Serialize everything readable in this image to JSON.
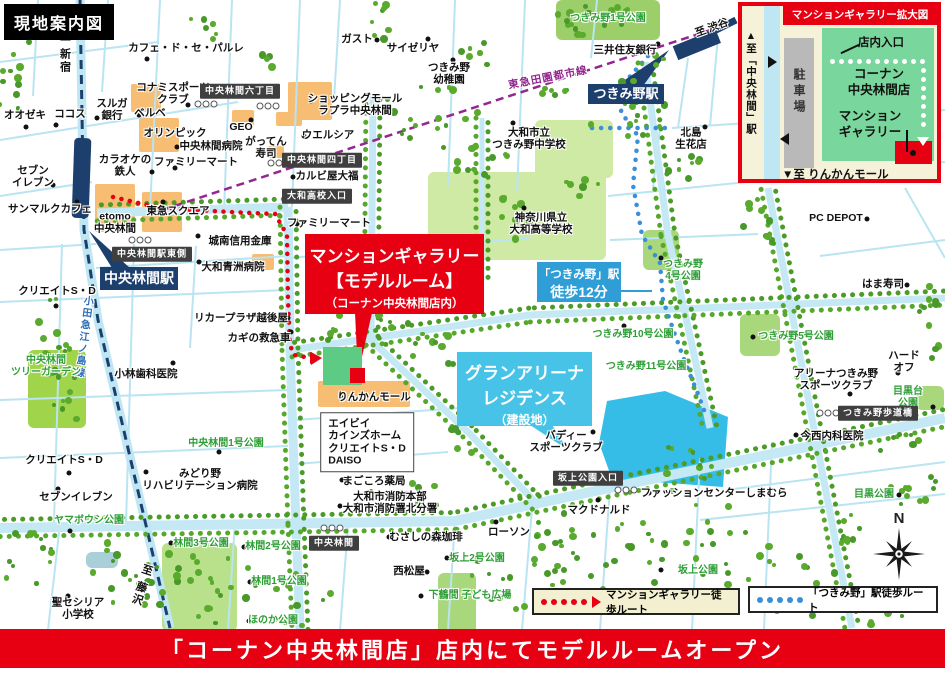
{
  "title": "現地案内図",
  "banner": "「コーナン中央林間店」店内にてモデルルームオープン",
  "compass": "N",
  "colors": {
    "accent_red": "#e60012",
    "navy": "#1c3f6e",
    "rail_purple": "#93278f",
    "route_blue": "#3a8fd8",
    "walk_box_blue": "#2f9ed6",
    "site_cyan": "#35bde8",
    "callout_cyan": "#47c3e8"
  },
  "legend": {
    "red_label": "マンションギャラリー徒歩ルート",
    "blue_label": "「つきみ野」駅徒歩ルート"
  },
  "stations": {
    "chuo_rinkan": "中央林間駅",
    "tsukimino": "つきみ野駅"
  },
  "callouts": {
    "gallery": {
      "line1": "マンションギャラリー",
      "line2": "【モデルルーム】",
      "line3": "（コーナン中央林間店内）"
    },
    "walk": {
      "line1": "「つきみ野」駅",
      "line2": "徒歩12分"
    },
    "site": {
      "line1": "グランアリーナ",
      "line2": "レジデンス",
      "line3": "（建設地）"
    }
  },
  "inset": {
    "title": "マンションギャラリー拡大図",
    "to_station": "▲至「中央林間」駅",
    "parking": "駐車場",
    "entrance": "店内入口",
    "store": "コーナン\n中央林間店",
    "gallery": "マンション\nギャラリー",
    "to_mall": "▼至 りんかんモール"
  },
  "map_labels": [
    {
      "t": "オオゼキ",
      "x": 25,
      "y": 115,
      "d": [
        26,
        127
      ]
    },
    {
      "t": "ココス",
      "x": 70,
      "y": 114,
      "d": [
        56,
        125
      ]
    },
    {
      "t": "至 新宿",
      "x": 64,
      "y": 52,
      "c": "railv"
    },
    {
      "t": "カフェ・ド・セ・パルレ",
      "x": 186,
      "y": 48,
      "d": [
        147,
        59
      ]
    },
    {
      "t": "スルガ\n銀行",
      "x": 112,
      "y": 110,
      "d": [
        97,
        118
      ]
    },
    {
      "t": "コナミスポーツ\nクラブ",
      "x": 173,
      "y": 94,
      "d": [
        188,
        105
      ]
    },
    {
      "t": "ベルベ",
      "x": 150,
      "y": 113,
      "d": [
        139,
        115
      ]
    },
    {
      "t": "中央林間六丁目",
      "x": 240,
      "y": 91,
      "c": "badge"
    },
    {
      "t": "オリンピック",
      "x": 175,
      "y": 133,
      "d": [
        148,
        134
      ]
    },
    {
      "t": "中央林間病院",
      "x": 211,
      "y": 146,
      "d": [
        177,
        147
      ]
    },
    {
      "t": "GEO",
      "x": 241,
      "y": 127,
      "d": [
        251,
        120
      ]
    },
    {
      "t": "がってん\n寿司",
      "x": 266,
      "y": 148
    },
    {
      "t": "カラオケの\n鉄人",
      "x": 125,
      "y": 166,
      "d": [
        152,
        172
      ]
    },
    {
      "t": "ファミリーマート",
      "x": 196,
      "y": 162,
      "d": [
        175,
        168
      ]
    },
    {
      "t": "セブン\nイレブン",
      "x": 33,
      "y": 177,
      "d": [
        53,
        185
      ]
    },
    {
      "t": "サンマルクカフェ",
      "x": 50,
      "y": 209,
      "d": [
        77,
        202
      ]
    },
    {
      "t": "etomo\n中央林間",
      "x": 115,
      "y": 223
    },
    {
      "t": "東急スクエア",
      "x": 178,
      "y": 211,
      "d": [
        163,
        202
      ]
    },
    {
      "t": "ガスト",
      "x": 357,
      "y": 39,
      "d": [
        377,
        40
      ]
    },
    {
      "t": "サイゼリヤ",
      "x": 413,
      "y": 48,
      "d": [
        428,
        39
      ]
    },
    {
      "t": "つきみ野\n幼稚園",
      "x": 449,
      "y": 74,
      "d": [
        453,
        60
      ]
    },
    {
      "t": "ショッピングモール\nラプラ中央林間",
      "x": 355,
      "y": 105,
      "d": [
        311,
        101
      ]
    },
    {
      "t": "ウエルシア",
      "x": 328,
      "y": 135,
      "d": [
        304,
        136
      ]
    },
    {
      "t": "中央林間四丁目",
      "x": 322,
      "y": 160,
      "c": "badge"
    },
    {
      "t": "カルビ屋大福",
      "x": 327,
      "y": 176,
      "d": [
        293,
        177
      ]
    },
    {
      "t": "大和高校入口",
      "x": 317,
      "y": 196,
      "c": "badge"
    },
    {
      "t": "ファミリーマート",
      "x": 329,
      "y": 223,
      "d": [
        297,
        224
      ]
    },
    {
      "t": "三井住友銀行",
      "x": 625,
      "y": 50,
      "d": [
        658,
        44
      ]
    },
    {
      "t": "至 渋谷",
      "x": 712,
      "y": 28,
      "r": -20
    },
    {
      "t": "東急田園都市線",
      "x": 548,
      "y": 78,
      "c": "railp",
      "r": -11
    },
    {
      "t": "北島\n生花店",
      "x": 691,
      "y": 139,
      "d": [
        705,
        127
      ]
    },
    {
      "t": "つきみ野1号公園",
      "x": 608,
      "y": 19,
      "c": "park-t"
    },
    {
      "t": "大和市立\nつきみ野中学校",
      "x": 529,
      "y": 139,
      "d": [
        513,
        123
      ]
    },
    {
      "t": "神奈川県立\n大和高等学校",
      "x": 541,
      "y": 224,
      "d": [
        524,
        208
      ]
    },
    {
      "t": "城南信用金庫",
      "x": 240,
      "y": 241,
      "d": [
        198,
        236
      ]
    },
    {
      "t": "大和青洲病院",
      "x": 233,
      "y": 267,
      "d": [
        199,
        262
      ]
    },
    {
      "t": "中央林間駅東側",
      "x": 152,
      "y": 254,
      "c": "badge"
    },
    {
      "t": "クリエイトS・D",
      "x": 57,
      "y": 291,
      "d": [
        56,
        306
      ]
    },
    {
      "t": "リカープラザ越後屋",
      "x": 241,
      "y": 318,
      "d": [
        288,
        318
      ]
    },
    {
      "t": "カギの救急車",
      "x": 259,
      "y": 338,
      "d": [
        291,
        332
      ]
    },
    {
      "t": "小田急江ノ島線",
      "x": 82,
      "y": 337,
      "c": "railb",
      "r": 7
    },
    {
      "t": "中央林間\nツリーガーデン",
      "x": 46,
      "y": 367,
      "c": "park-t"
    },
    {
      "t": "小林歯科医院",
      "x": 146,
      "y": 374,
      "d": [
        173,
        363
      ]
    },
    {
      "t": "つきみ野\n4号公園",
      "x": 683,
      "y": 271,
      "c": "park-t",
      "d": [
        661,
        258
      ]
    },
    {
      "t": "つきみ野10号公園",
      "x": 633,
      "y": 335,
      "c": "park-t",
      "d": [
        624,
        326
      ]
    },
    {
      "t": "つきみ野11号公園",
      "x": 646,
      "y": 367,
      "c": "park-t"
    },
    {
      "t": "つきみ野5号公園",
      "x": 796,
      "y": 337,
      "c": "park-t",
      "d": [
        753,
        337
      ]
    },
    {
      "t": "PC DEPOT",
      "x": 836,
      "y": 218,
      "d": [
        867,
        219
      ]
    },
    {
      "t": "はま寿司",
      "x": 883,
      "y": 284,
      "d": [
        907,
        285
      ]
    },
    {
      "t": "ハードオフ",
      "x": 904,
      "y": 362,
      "d": [
        898,
        373
      ]
    },
    {
      "t": "アリーナつきみ野\nスポーツクラブ",
      "x": 836,
      "y": 380,
      "d": [
        850,
        394
      ]
    },
    {
      "t": "目黒台公園",
      "x": 908,
      "y": 398,
      "c": "park-t",
      "d": [
        933,
        407
      ]
    },
    {
      "t": "つきみ野歩道橋",
      "x": 878,
      "y": 413,
      "c": "badge"
    },
    {
      "t": "今西内科医院",
      "x": 832,
      "y": 436,
      "d": [
        796,
        435
      ]
    },
    {
      "t": "目黒公園",
      "x": 874,
      "y": 495,
      "c": "park-t",
      "d": [
        899,
        495
      ]
    },
    {
      "t": "バディー\nスポーツクラブ",
      "x": 566,
      "y": 442,
      "d": [
        593,
        432
      ]
    },
    {
      "t": "坂上公園入口",
      "x": 588,
      "y": 478,
      "c": "badge"
    },
    {
      "t": "ファッションセンターしまむら",
      "x": 714,
      "y": 493,
      "d": [
        649,
        493
      ]
    },
    {
      "t": "マクドナルド",
      "x": 599,
      "y": 510,
      "d": [
        598,
        500
      ]
    },
    {
      "t": "坂上公園",
      "x": 698,
      "y": 571,
      "c": "park-t",
      "d": [
        661,
        570
      ]
    },
    {
      "t": "中央林間1号公園",
      "x": 226,
      "y": 444,
      "c": "park-t",
      "d": [
        219,
        452
      ]
    },
    {
      "t": "クリエイトS・D",
      "x": 64,
      "y": 460,
      "d": [
        69,
        473
      ]
    },
    {
      "t": "みどり野\nリハビリテーション病院",
      "x": 200,
      "y": 480,
      "d": [
        146,
        472
      ]
    },
    {
      "t": "セブンイレブン",
      "x": 76,
      "y": 497,
      "d": [
        58,
        489
      ]
    },
    {
      "t": "ヤマボウシ公園",
      "x": 89,
      "y": 521,
      "c": "park-t",
      "d": [
        70,
        531
      ]
    },
    {
      "t": "林間3号公園",
      "x": 201,
      "y": 544,
      "c": "park-t",
      "d": [
        171,
        543
      ]
    },
    {
      "t": "林間2号公園",
      "x": 273,
      "y": 547,
      "c": "park-t",
      "d": [
        244,
        547
      ]
    },
    {
      "t": "林間1号公園",
      "x": 279,
      "y": 582,
      "c": "park-t",
      "d": [
        250,
        582
      ]
    },
    {
      "t": "ほのか公園",
      "x": 273,
      "y": 621,
      "c": "park-t",
      "d": [
        249,
        621
      ]
    },
    {
      "t": "聖セシリア\n小学校",
      "x": 78,
      "y": 609,
      "d": [
        68,
        596
      ]
    },
    {
      "t": "至 藤沢",
      "x": 141,
      "y": 585,
      "c": "railv",
      "r": 18
    },
    {
      "t": "中央林間",
      "x": 334,
      "y": 543,
      "c": "badge"
    },
    {
      "t": "りんかんモール",
      "x": 374,
      "y": 397,
      "d": [
        341,
        397
      ]
    },
    {
      "t": "エイビイ\nカインズホーム\nクリエイトS・D\nDAISO",
      "x": 367,
      "y": 442,
      "c": "listbox"
    },
    {
      "t": "まごころ薬局",
      "x": 374,
      "y": 481,
      "d": [
        342,
        480
      ]
    },
    {
      "t": "大和市消防本部\n大和市消防署北分署",
      "x": 390,
      "y": 503,
      "d": [
        340,
        506
      ]
    },
    {
      "t": "むさしの森珈琲",
      "x": 426,
      "y": 537,
      "d": [
        389,
        537
      ]
    },
    {
      "t": "ローソン",
      "x": 509,
      "y": 532,
      "d": [
        496,
        522
      ]
    },
    {
      "t": "西松屋",
      "x": 409,
      "y": 571,
      "d": [
        427,
        572
      ]
    },
    {
      "t": "坂上2号公園",
      "x": 477,
      "y": 559,
      "c": "park-t",
      "d": [
        447,
        558
      ]
    },
    {
      "t": "下鶴間 子ども広場",
      "x": 470,
      "y": 596,
      "c": "park-t",
      "d": [
        421,
        596
      ]
    }
  ]
}
